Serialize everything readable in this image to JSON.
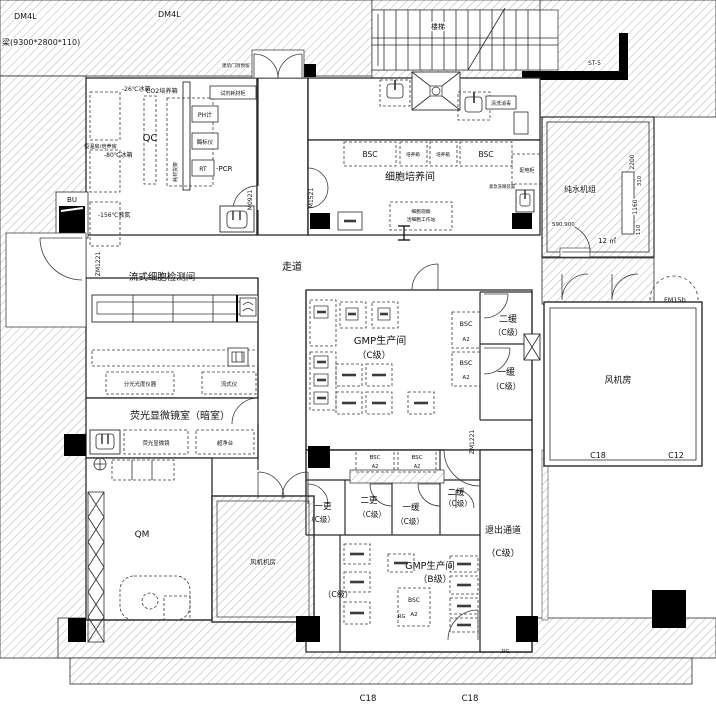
{
  "notes": {
    "dm4l_a": "DM4L",
    "dm4l_b": "DM4L",
    "beam": "梁(9300*2800*110)",
    "door_reserve": "建筑门洞预留",
    "stairs": "楼梯",
    "st5": "ST-5",
    "rg_a": "RG",
    "rg_b": "RG"
  },
  "rooms": {
    "qc": "QC",
    "cell_culture": "细胞培养间",
    "flow": "流式细胞检测间",
    "fluorescence": "荧光显微镜室（暗室）",
    "qm": "QM",
    "fan_small": "风机机房",
    "pure_water": "纯水机组",
    "fan_room": "风机房",
    "corridor": "走道",
    "gmp_c": {
      "l1": "GMP生产间",
      "l2": "（C级）"
    },
    "gmp_b": {
      "l1": "GMP生产间",
      "l2": "（B级）"
    },
    "buffer2_c": {
      "l1": "二缓",
      "l2": "（C级）"
    },
    "buffer1_c": {
      "l1": "一缓",
      "l2": "（C级）"
    },
    "change1": {
      "l1": "一更",
      "l2": "（C级）"
    },
    "change2": {
      "l1": "二更",
      "l2": "（C级）"
    },
    "buffer1_b": {
      "l1": "一缓",
      "l2": "（C级）"
    },
    "buffer2_b": {
      "l1": "二缓",
      "l2": "（C级）"
    },
    "exit": {
      "l1": "退出通道",
      "l2": "（C级）"
    },
    "c_corner": "（C级）"
  },
  "doors": {
    "m0921": "M0921",
    "m1521": "M1521",
    "zm1221_a": "ZM1221",
    "zm1221_b": "ZM1221",
    "fm15b": "FM15b",
    "bu": "BU"
  },
  "dims": {
    "w2200": "2200",
    "w310": "310",
    "w1160": "1160",
    "w110": "110",
    "w590": "590,900",
    "area": "12 ㎡"
  },
  "grid": {
    "c18_fan": "C18",
    "c12_fan": "C12",
    "c18_a": "C18",
    "c18_b": "C18"
  },
  "equipment": {
    "freezer26": "-26℃冰箱",
    "incubator_room": "恒温房/培养房",
    "freezer80": "-80℃冰箱",
    "ln156": "-156℃液氮",
    "co2": "CO2培养箱",
    "ph": "PH计",
    "reader": "酶标仪",
    "rt": "RT",
    "pcr": "-PCR",
    "shelf": "耗材货架",
    "reagent": "试剂耗材柜",
    "bsc": "BSC",
    "a2": "A2",
    "incubator": "培养箱",
    "ws1": "细胞观察",
    "ws2": "活细胞工作站",
    "power": "配电柜",
    "eyewash": "紧急洗眼装置",
    "wash": "清洗消毒",
    "spectro": "分光光度仪器",
    "flow_cyto": "流式仪",
    "fluor_micro": "荧光显微镜",
    "clean_bench": "超净台"
  }
}
